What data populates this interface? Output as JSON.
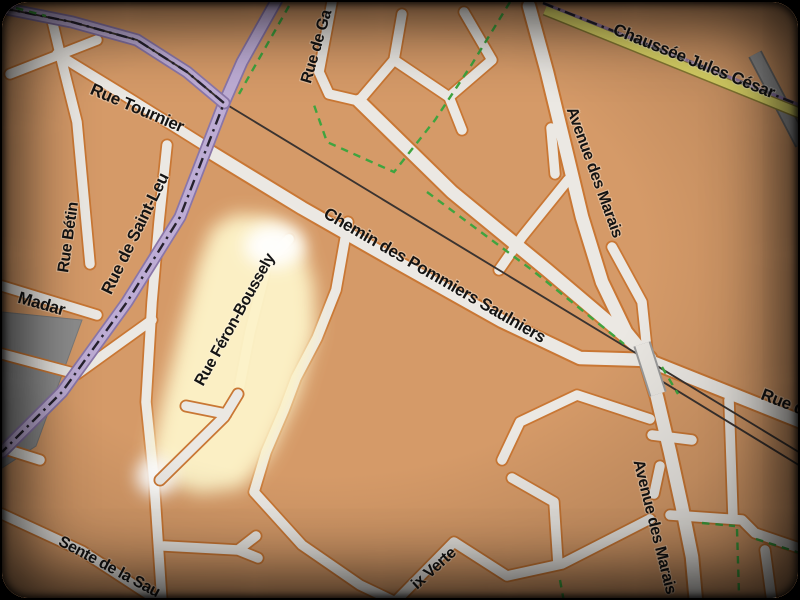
{
  "map": {
    "kind": "street-map",
    "highlighted_street": "Rue Féron-Boussely",
    "labels": {
      "rue_tournier": "Rue Tournier",
      "rue_betin": "Rue Bétin",
      "rue_de_saint_leu": "Rue de Saint-Leu",
      "madar": "Madar",
      "rue_de_ga": "Rue de Ga",
      "chaussee_jules_cesar": "Chaussée Jules César",
      "avenue_des_marais_upper": "Avenue des Marais",
      "chemin_des_pommiers_saulniers": "Chemin des Pommiers Saulniers",
      "rue_feron_boussely": "Rue Féron-Boussely",
      "sente_de_la_sau": "Sente de la Sau",
      "croix_verte_partial": "ix Verte",
      "avenue_des_marais_lower": "Avenue des Marais",
      "rue_d_partial": "Rue d"
    },
    "colors": {
      "land": "#d59a68",
      "road_fill": "#ebe8e3",
      "road_casing": "#c97734",
      "boundary_purple": "#c2b3d8",
      "secondary_yellow": "#e8e06c",
      "path_green": "#3fa43f",
      "railway": "#3a3330",
      "gray_area": "#8d8d8d",
      "route_highlight": "#fdf3c8",
      "label_text": "#141414"
    }
  }
}
